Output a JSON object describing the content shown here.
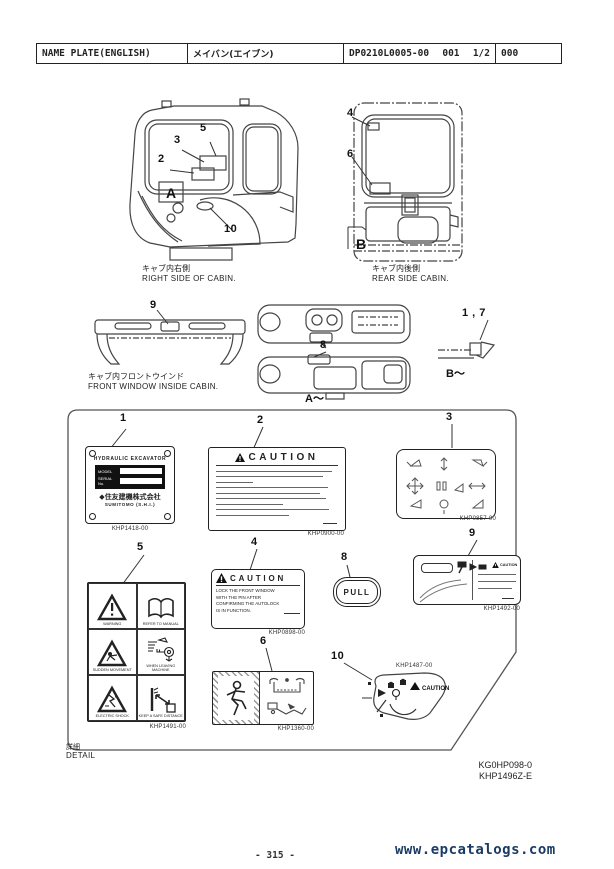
{
  "header": {
    "title_en": "NAME PLATE(ENGLISH)",
    "title_ja": "メイバン(エイブン)",
    "doc_no": "DP0210L0005-00",
    "sheet": "001",
    "page": "1/2",
    "rev": "000"
  },
  "callouts": {
    "c1": "1",
    "c2": "2",
    "c3": "3",
    "c4": "4",
    "c5": "5",
    "c6": "6",
    "c8": "8",
    "c9": "9",
    "c10": "10",
    "c17": "1 , 7"
  },
  "section_markers": {
    "a": "A",
    "b": "B",
    "a_ref": "A～",
    "b_ref": "B～"
  },
  "captions": {
    "right_side_ja": "キャブ内右側",
    "right_side_en": "RIGHT SIDE OF CABIN.",
    "rear_side_ja": "キャブ内後側",
    "rear_side_en": "REAR SIDE CABIN.",
    "front_window_ja": "キャブ内フロントウインド",
    "front_window_en": "FRONT WINDOW INSIDE CABIN."
  },
  "detail_box": {
    "label_ja": "詳細",
    "label_en": "DETAIL",
    "plate1": {
      "part": "KHP1418-00",
      "title": "HYDRAULIC EXCAVATOR",
      "field1": "MODEL",
      "field2": "SERIAL No.",
      "brand_ja": "住友建機株式会社",
      "brand_en": "SUMITOMO (S.H.I.)"
    },
    "plate2": {
      "part": "KHP0900-00",
      "title": "CAUTION"
    },
    "plate3": {
      "part": "KHP0857-00"
    },
    "plate4": {
      "part": "KHP0898-00",
      "title": "CAUTION",
      "line1": "LOCK THE FRONT WINDOW",
      "line2": "WITH THE PIN AFTER",
      "line3": "CONFIRMING THE AUTOLOCK",
      "line4": "IS IN FUNCTION."
    },
    "plate5": {
      "part": "KHP1491-00",
      "cell1": "WARNING",
      "cell2": "REFER TO MANUAL",
      "cell3": "SUDDEN MOVEMENT",
      "cell4": "WHEN LEAVING MACHINE",
      "cell5": "ELECTRIC SHOCK",
      "cell6": "KEEP A SAFE DISTANCE"
    },
    "plate6": {
      "part": "KHP1360-00"
    },
    "plate8": {
      "label": "PULL"
    },
    "plate9": {
      "part": "KHP1492-00",
      "caution": "CAUTION"
    },
    "plate10": {
      "part": "KHP1487-00",
      "caution": "CAUTION"
    }
  },
  "drawing_refs": {
    "ref1": "KG0HP098-0",
    "ref2": "KHP1496Z-E"
  },
  "footer": {
    "page_no": "- 315 -",
    "site": "www.epcatalogs.com"
  },
  "colors": {
    "site_link": "#1b3b66",
    "line": "#444444"
  }
}
